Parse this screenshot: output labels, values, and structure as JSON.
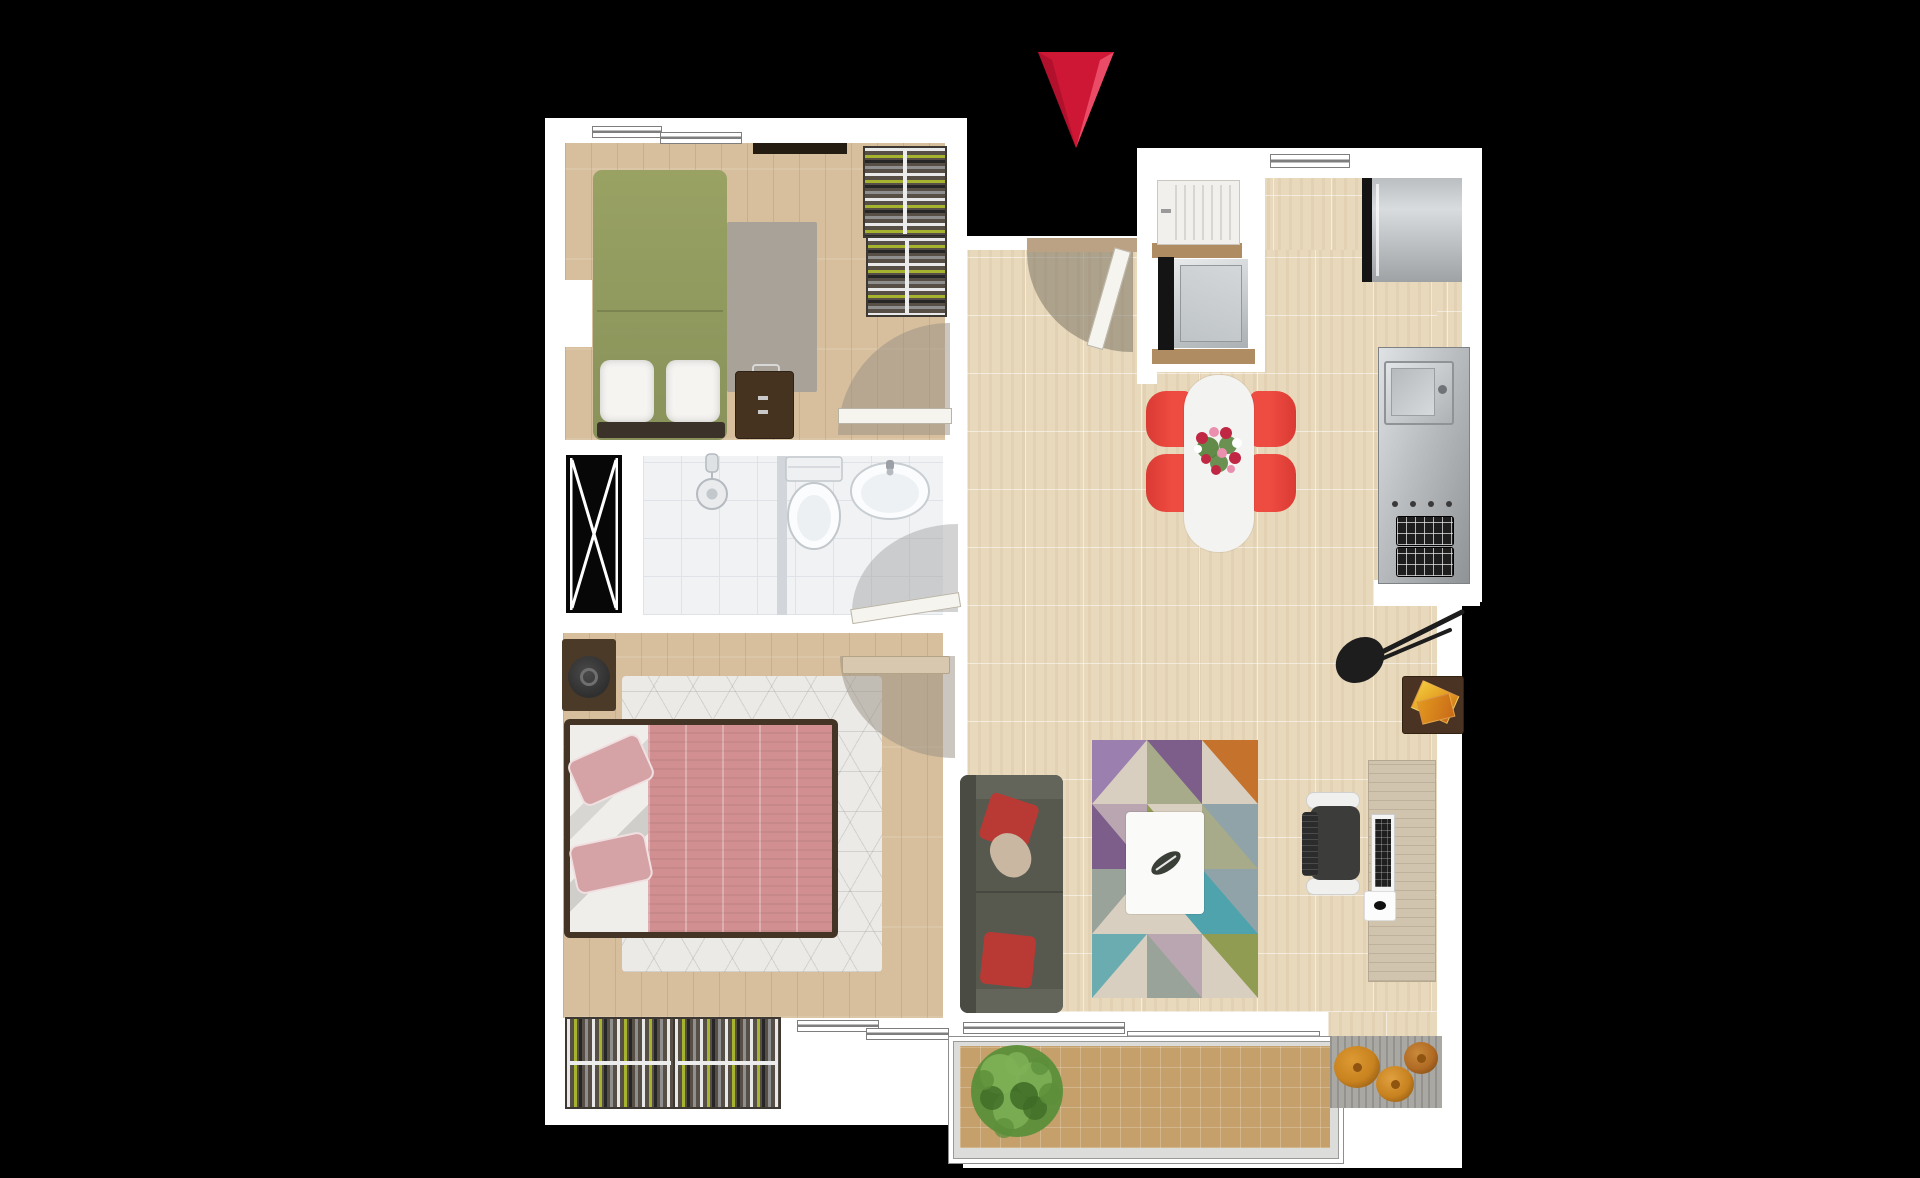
{
  "canvas": {
    "width": 1920,
    "height": 1178,
    "view": "top-down apartment floor plan on black background"
  },
  "icons": {
    "entrance_marker": "red-triangle-down-arrow",
    "shaft_symbol": "black-box-with-white-x",
    "door_swings": "quarter-circle-arc-with-leaf",
    "windows": "double-line-bar"
  },
  "colors": {
    "background": "#000000",
    "wall": "#ffffff",
    "wood_floor": "#d7bf9e",
    "wood_line": "rgba(140,100,60,0.18)",
    "tile_floor": "#e8d9bd",
    "tile_line": "rgba(255,255,255,0.5)",
    "tile_shade": "rgba(190,160,115,0.14)",
    "bath_floor": "#f1f2f4",
    "bath_line": "#dfe2e6",
    "bath_divider": "#d2d5d9",
    "shaft_bg": "#070707",
    "shaft_line": "#ffffff",
    "arrow_red": "#ce1635",
    "arrow_red_light": "#ef5570",
    "arrow_red_dark": "#9e0f26",
    "bed_green": "#99a263",
    "bed_green_dark": "#88925a",
    "pillow_white": "#f5f4f1",
    "bed_base_dark": "#3b332a",
    "rug_gray": "#a8a298",
    "wardrobe_dark": "#574f46",
    "wardrobe_rail": "#ececec",
    "clothes_green": "#a6b32f",
    "clothes_white": "#e8e8e8",
    "clothes_black": "#262626",
    "clothes_gray": "#8f8f8f",
    "suitcase_brown": "#45331f",
    "lintel_dark": "#241c11",
    "master_rug": "#ebeae6",
    "master_rug_line": "rgba(80,80,80,0.16)",
    "bed_frame_brown": "#443426",
    "duvet_pink": "#d28f91",
    "duvet_fold": "rgba(255,255,255,0.28)",
    "sheet_white": "#f0eeea",
    "pillow_pink": "#d5a3a6",
    "nightstand_brown": "#4c3a28",
    "device_dark": "#2f2f2f",
    "door_leaf": "#f6f4ef",
    "door_leaf_edge": "#b9b4a6",
    "door_leaf_wood": "#d8c8b0",
    "door_arc": "rgba(151,143,129,0.5)",
    "door_arc_dark": "rgba(124,116,101,0.55)",
    "sill_tan": "#bca285",
    "sofa_gray": "#57594f",
    "sofa_gray_light": "#63655b",
    "sofa_back": "#4a4c43",
    "cushion_red": "#b93a35",
    "cushion_beige": "#c9b7a2",
    "coffee_table": "#fafaf8",
    "rug_purple": "#9b7fae",
    "rug_plum": "#7d5d8a",
    "rug_olive": "#8f9c52",
    "rug_sage": "#a7ab8a",
    "rug_teal": "#4fa3ad",
    "rug_steel": "#8fa3a8",
    "rug_orange": "#c5732c",
    "rug_sand": "#d9cfc0",
    "rug_gray2": "#9aa39a",
    "rug_mauve": "#b9a6b0",
    "desk_wood": "#d1c4ae",
    "desk_grain": "rgba(125,105,80,0.22)",
    "chair_dark": "#3c3c3a",
    "chair_white": "#f0f0ee",
    "chair_back": "#2c2c2c",
    "keyboard_dark": "#1f1f1f",
    "key_line": "rgba(255,255,255,0.25)",
    "lamp_black": "#1d1d1d",
    "side_table_brown": "#4a3322",
    "book_orange": "#e2991f",
    "book_rust": "#c96a18",
    "dining_table": "#f3f3f2",
    "chair_red": "#ee4b41",
    "chair_red_dark": "#d93a33",
    "flower_red": "#bf2743",
    "flower_pink": "#eb8fae",
    "flower_white": "#ffffff",
    "flower_green": "#527f36",
    "stainless": "#b9bdbf",
    "stainless_dark": "#8f9396",
    "appliance_black": "#141414",
    "counter_wood": "#b08c62",
    "washer_white": "#f1f0ec",
    "washer_line": "#d8d6d0",
    "burner_black": "#1e1e1e",
    "burner_line": "rgba(230,230,230,0.75)",
    "balcony_mat": "#c6a06a",
    "balcony_grid": "rgba(255,255,255,0.22)",
    "balcony_frame": "#dcdcda",
    "pouf_rug": "#a9a8a3",
    "pouf_orange": "#c8821f",
    "pouf_orange_dark": "#8f5410",
    "pouf_rust": "#b06a24",
    "plant_green": "#5c8f3a",
    "plant_green_light": "#7fb257",
    "plant_green_dark": "#3e6b26",
    "window_frame": "#7e7e7e"
  }
}
